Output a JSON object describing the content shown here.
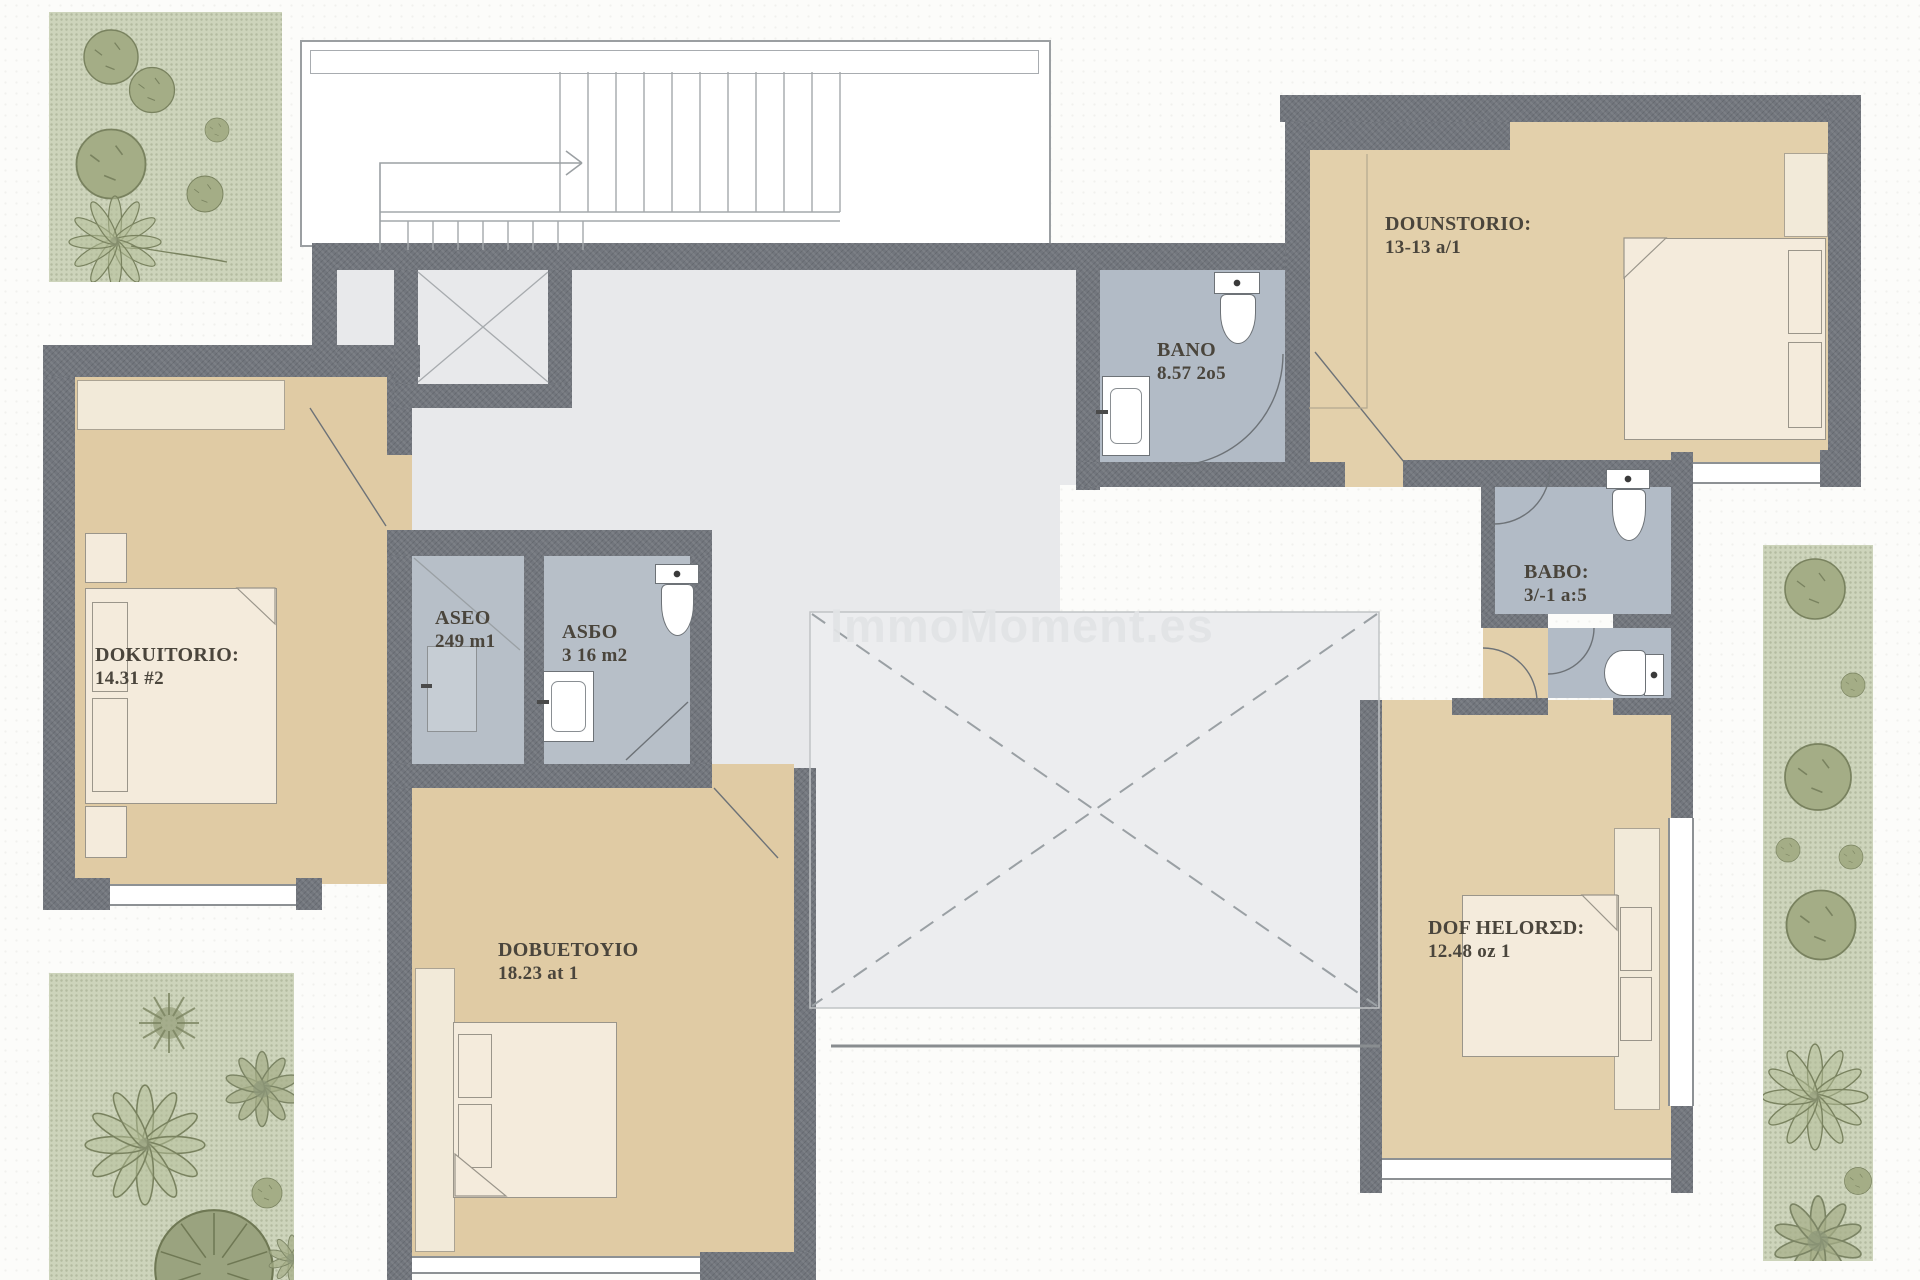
{
  "watermark": "ImmoMoment.es",
  "palette": {
    "wall": "#72767d",
    "hall_floor": "#e8e9eb",
    "void_floor": "#ecedef",
    "bedroom_floor": "#e0cba4",
    "bath_floor": "#b2bbc6",
    "furniture": "#f4ebdc",
    "garden": "#cdd4bb",
    "plant": "#a4ad86",
    "linework": "#6d7277"
  },
  "rooms": [
    {
      "id": "dounstorio",
      "name": "DOUNSTORIO:",
      "area": "13-13 a/1"
    },
    {
      "id": "bano",
      "name": "BANO",
      "area": "8.57 2o5"
    },
    {
      "id": "babo",
      "name": "BABO:",
      "area": "3/-1 a:5"
    },
    {
      "id": "aseo",
      "name": "ASEO",
      "area": "249 m1"
    },
    {
      "id": "asbo",
      "name": "ASБO",
      "area": "3 16 m2"
    },
    {
      "id": "dokuitorio",
      "name": "DOKUITORIO:",
      "area": "14.31 #2"
    },
    {
      "id": "dobuetoyio",
      "name": "DOBUETOYIO",
      "area": "18.23 at 1"
    },
    {
      "id": "dof_helored",
      "name": "DOF HELORΣD:",
      "area": "12.48 oz 1"
    }
  ]
}
